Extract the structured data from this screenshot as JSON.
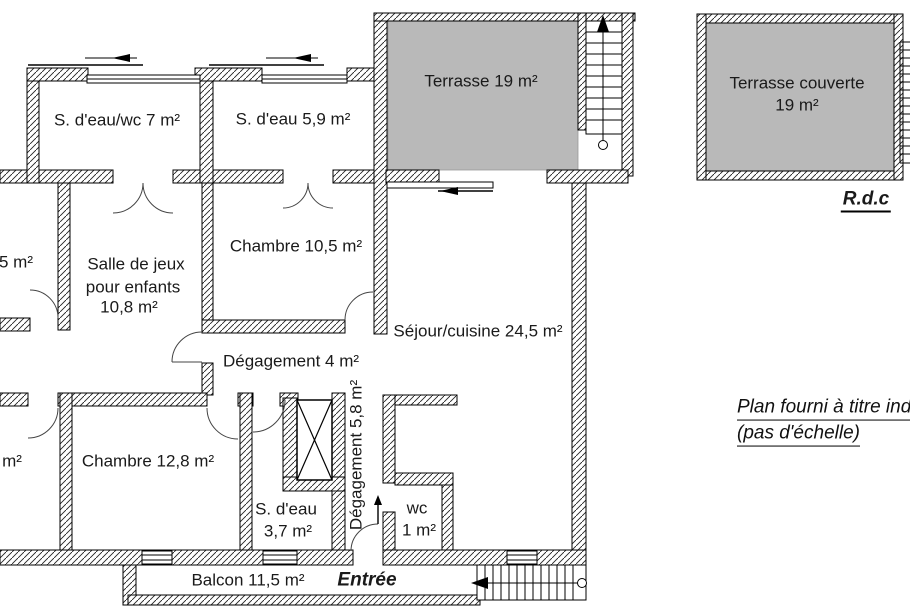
{
  "plan": {
    "rooms": {
      "sdeau_wc": "S. d'eau/wc 7 m²",
      "sdeau59": "S. d'eau 5,9 m²",
      "terrasse": "Terrasse 19 m²",
      "terrasse_couverte_l1": "Terrasse couverte",
      "terrasse_couverte_l2": "19 m²",
      "room_left_top_partial": "5 m²",
      "salle_l1": "Salle de jeux",
      "salle_l2": "pour enfants",
      "salle_l3": "10,8 m²",
      "chambre105": "Chambre 10,5 m²",
      "sejour": "Séjour/cuisine 24,5 m²",
      "degagement4": "Dégagement 4 m²",
      "degagement58": "Dégagement 5,8 m²",
      "chambre128": "Chambre 12,8 m²",
      "room_left_bottom_partial": "m²",
      "sdeau37_l1": "S. d'eau",
      "sdeau37_l2": "3,7 m²",
      "wc_l1": "wc",
      "wc_l2": "1 m²",
      "balcon": "Balcon 11,5 m²",
      "entree": "Entrée"
    },
    "annotations": {
      "level": "R.d.c",
      "note_l1": "Plan fourni à titre indic",
      "note_l2": "(pas d'échelle)"
    },
    "colors": {
      "terrace_fill": "#b9b9b9",
      "wall_line": "#000000",
      "background": "#ffffff"
    }
  }
}
